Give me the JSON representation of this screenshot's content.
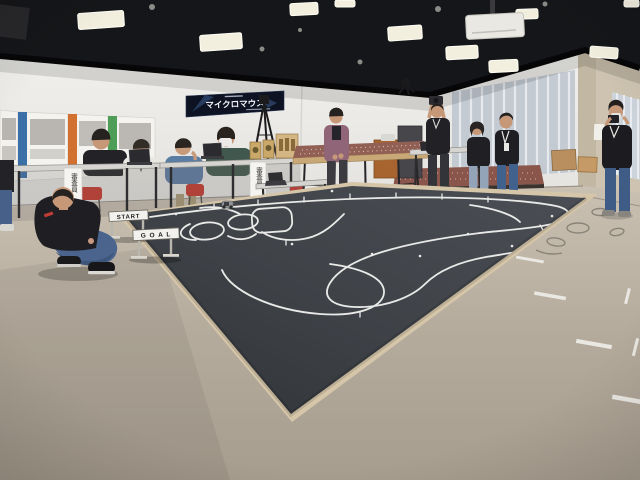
{
  "scene": {
    "setting": "indoor robotics competition venue (micromouse / robotrace event) in a conference room",
    "banner": {
      "title": "マイクロマウス"
    },
    "track_signs": {
      "start": "START",
      "goal": "G O A L"
    },
    "judge_sign": "審査員",
    "colors": {
      "ceiling": "#151619",
      "wall": "#ececea",
      "right_wall_beige": "#cdc3b0",
      "carpet": "#b7ad9f",
      "course_mat": "#3e4247",
      "course_line": "#e9e9e7",
      "mat_wood_edge": "#d6c6a9",
      "maze_board": "#8d5a50",
      "banner_bg": "#0d1322",
      "chair_red": "#b0423a"
    },
    "objects": [
      "ceiling-lights",
      "projector",
      "event-banner",
      "exhibition-posters",
      "judges-tables",
      "seated-judges",
      "judge-signs",
      "trophies",
      "laptops",
      "camera-tripod",
      "lectern",
      "av-cabinet",
      "maze-tables",
      "maze-board-on-floor",
      "cardboard-boxes",
      "window-blinds",
      "standing-attendees",
      "photographer-with-camera",
      "photographer-with-phone",
      "robotrace-course-mat",
      "line-following-robot",
      "start-hurdle-sign",
      "goal-hurdle-sign",
      "crouching-participant",
      "red-chairs",
      "carpet-floor",
      "floor-tape-marks",
      "cable-coils"
    ]
  }
}
